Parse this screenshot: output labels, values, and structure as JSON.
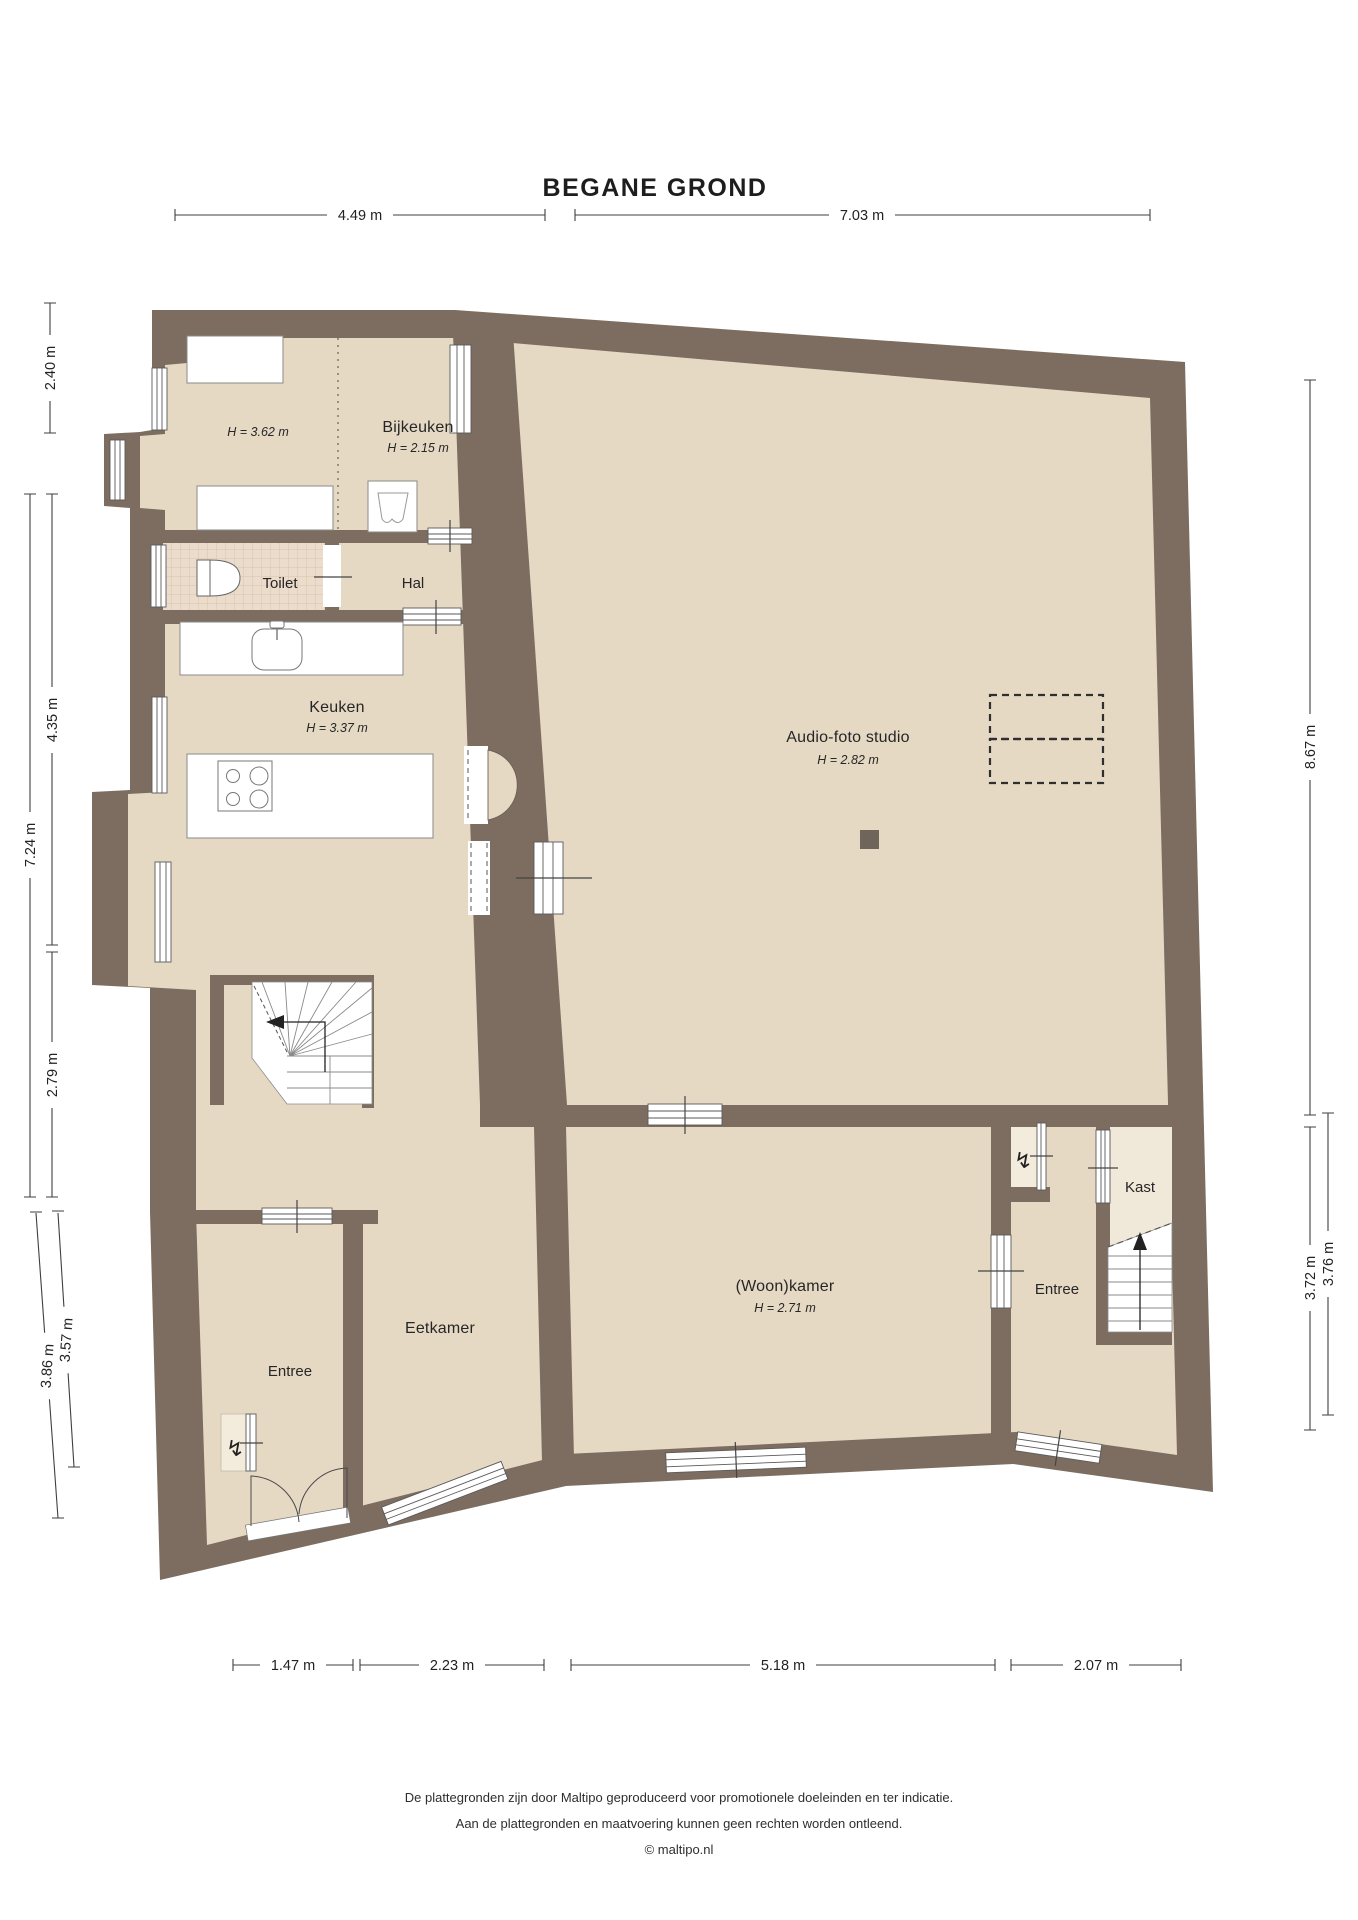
{
  "title": "BEGANE GROND",
  "rooms": {
    "area_left": {
      "height": "H = 3.62 m"
    },
    "bijkeuken": {
      "name": "Bijkeuken",
      "height": "H = 2.15 m"
    },
    "toilet": {
      "name": "Toilet"
    },
    "hal": {
      "name": "Hal"
    },
    "keuken": {
      "name": "Keuken",
      "height": "H = 3.37 m"
    },
    "studio": {
      "name": "Audio-foto studio",
      "height": "H = 2.82 m"
    },
    "kast": {
      "name": "Kast"
    },
    "entree_rechts": {
      "name": "Entree"
    },
    "woonkamer": {
      "name": "(Woon)kamer",
      "height": "H = 2.71 m"
    },
    "eetkamer": {
      "name": "Eetkamer"
    },
    "entree_links": {
      "name": "Entree"
    }
  },
  "dimensions": {
    "top": [
      {
        "label": "4.49 m"
      },
      {
        "label": "7.03 m"
      }
    ],
    "left": [
      {
        "label": "2.40 m"
      },
      {
        "label": "4.35 m"
      },
      {
        "label": "7.24 m"
      },
      {
        "label": "2.79 m"
      },
      {
        "label": "3.86 m"
      },
      {
        "label": "3.57 m"
      }
    ],
    "right": [
      {
        "label": "8.67 m"
      },
      {
        "label": "3.72 m"
      },
      {
        "label": "3.76 m"
      }
    ],
    "bottom": [
      {
        "label": "1.47 m"
      },
      {
        "label": "2.23 m"
      },
      {
        "label": "5.18 m"
      },
      {
        "label": "2.07 m"
      }
    ]
  },
  "footer": {
    "disclaimer_line1": "De plattegronden zijn door Maltipo geproduceerd voor promotionele doeleinden en ter indicatie.",
    "disclaimer_line2": "Aan de plattegronden en maatvoering kunnen geen rechten worden ontleend.",
    "copyright": "© maltipo.nl"
  },
  "icons": {
    "electric_meter": "↯"
  },
  "colors": {
    "wall": "#7c6d60",
    "floor": "#e6d9c4",
    "tile": "#ecdccb",
    "kast_floor": "#f0e8d8"
  }
}
